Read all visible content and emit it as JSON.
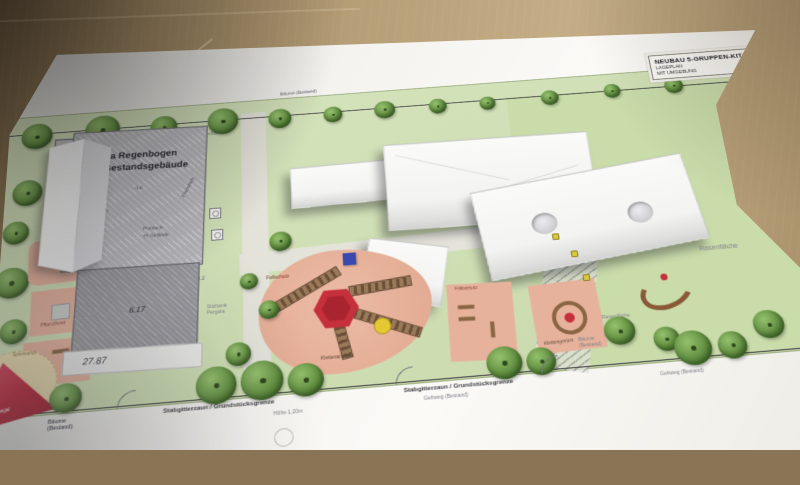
{
  "title_block": {
    "line1": "NEUBAU 5-GRUPPEN-KITA",
    "line2": "LAGEPLAN",
    "line3": "MIT UMGEBUNG"
  },
  "existing_building": {
    "name_line1": "Kita Regenbogen",
    "name_line2": "Bestandsgebäude",
    "roof_flat": "Flachdach",
    "roof_mono": "Pultdach",
    "ground_level": "±0 Gelände",
    "level_a": "+3.6",
    "level_b": "-1.6",
    "level_c": "+1.2",
    "dim_a": "6.17",
    "dim_b": "27.87"
  },
  "labels": {
    "fallschutz": "Fallschutz",
    "kletteranlage": "Kletteranlage",
    "klettergeruest": "Klettergerüst",
    "terrasse": "Terrasse",
    "pflanzbeet": "Pflanzbeet",
    "sitzbank_pergola": "Sitzbank Pergola",
    "spielsand": "Spielsand",
    "sonnensegel": "Sonnensegel",
    "rasenflaeche": "Rasenfläche",
    "baeume_bestand": "Bäume (Bestand)",
    "stabgitterzaun": "Stabgitterzaun / Grundstücksgrenze",
    "gehweg": "Gehweg (Bestand)",
    "hoehe": "Höhe 1,20m"
  },
  "colors": {
    "table_wood": "#b59d76",
    "paper": "#f2f1ed",
    "site_green": "#cfdfb4",
    "tree_green": "#628f41",
    "play_salmon": "#e7b29c",
    "accent_red": "#c5303c",
    "model_white": "#f3f3f1",
    "building_gray": "#b7b7bb"
  }
}
